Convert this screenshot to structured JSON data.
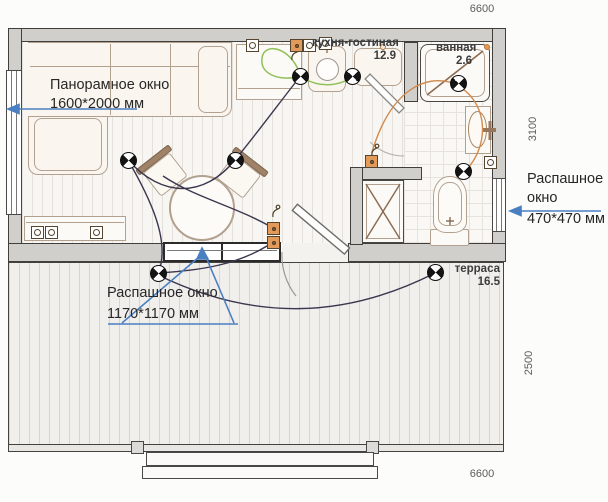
{
  "title": "floor plan",
  "dimensions": {
    "top": "6600",
    "right_upper": "3100",
    "right_lower": "2500",
    "bottom": "6600"
  },
  "rooms": {
    "kitchen_living": {
      "name": "кухня-гостиная",
      "area": "12.9"
    },
    "bathroom": {
      "name": "ванная",
      "area": "2.6"
    },
    "terrace": {
      "name": "терраса",
      "area": "16.5"
    }
  },
  "annotations": {
    "panoramic_window": {
      "line1": "Панорамное окно",
      "line2": "1600*2000 мм"
    },
    "casement_window_small": {
      "line1": "Распашное",
      "line2": "окно",
      "line3": "470*470 мм"
    },
    "casement_window_terrace": {
      "line1": "Распашное окно",
      "line2": "1170*1170 мм"
    }
  },
  "icons": {
    "ceiling_light": "quartered-circle",
    "power_socket": "square-with-dot",
    "switch": "hook-with-dot"
  },
  "colors": {
    "wall_fill": "#d1cfcb",
    "wall_line": "#413f3b",
    "furniture_line": "#b3a190",
    "wire_dark": "#3c3750",
    "wire_green": "#8fc158",
    "wire_orange": "#d28a4d",
    "annotation_blue": "#4a7fc1"
  }
}
